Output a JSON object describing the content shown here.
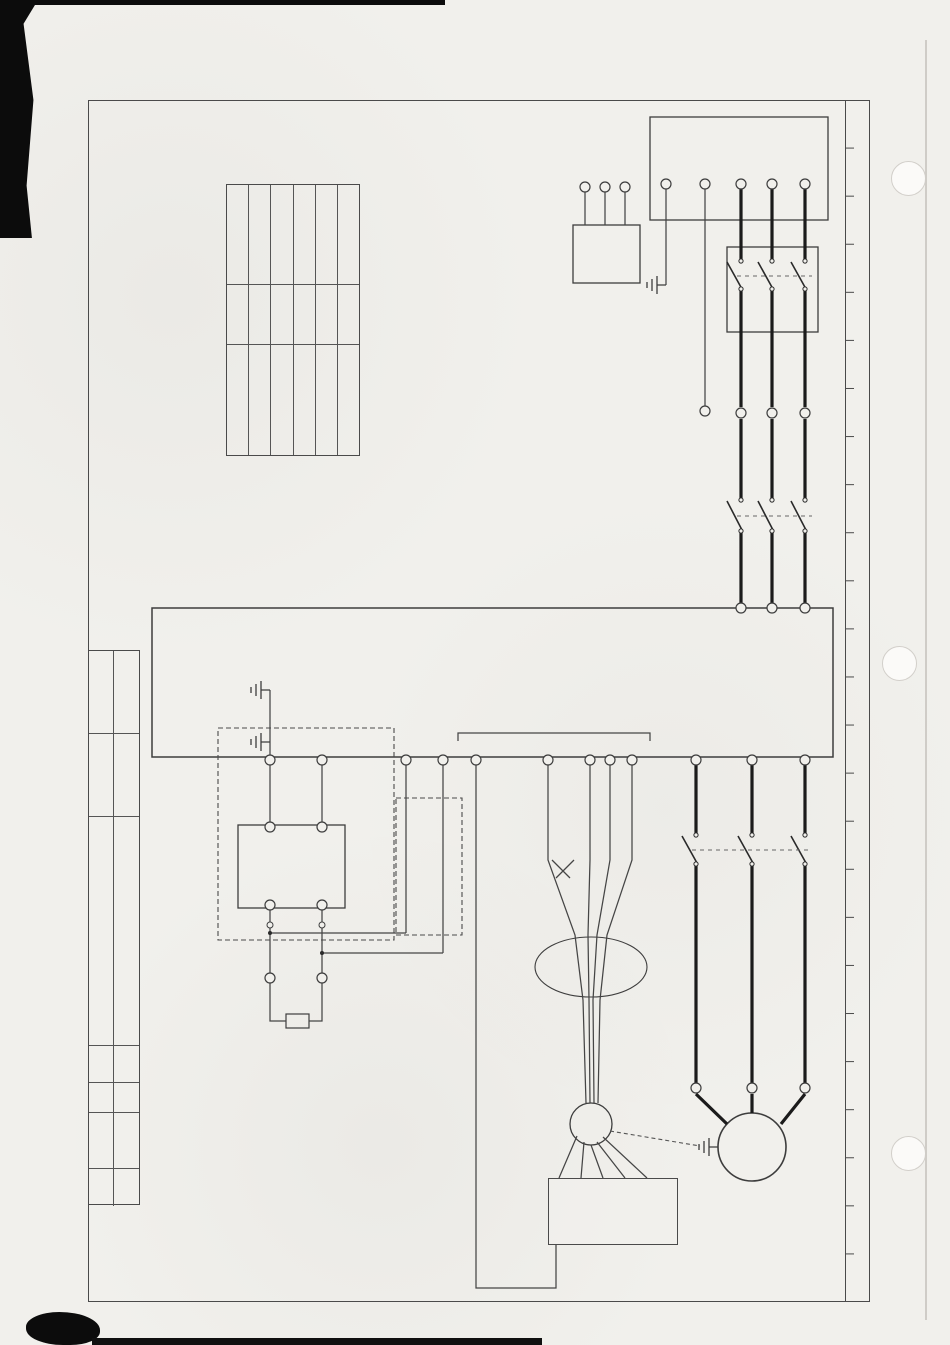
{
  "header": {
    "source_note": "本资料来自赛尔电梯网：http://dt.saier360.com/"
  },
  "frame": {
    "zone_letters": [
      "A",
      "B",
      "C",
      "D",
      "E",
      "F",
      "G",
      "H",
      "I",
      "J",
      "K",
      "L",
      "M",
      "N",
      "O",
      "P",
      "Q",
      "R",
      "S",
      "T",
      "U",
      "V",
      "W",
      "X",
      "Y"
    ]
  },
  "notes_right": [
    "1：用户需要根据土建要求，提供符合要求的三相五线电源。",
    "2：NICE3000一体化控制器，在30KW及以下功率机型都标准配置制动单元。37KW及其以上功率的机型需要外配制动单元。",
    "3：制动电阻参照以下电阻选型表配置"
  ],
  "notes_left": [
    "4：异步电机适配编码器为推挽输出，开路集电极输出的增量型编码器。",
    "5：编码器屏蔽线最好单端接地，当用户地线不稳定时，可以将屏蔽层接至控制板CN6的PGM端子。"
  ],
  "model_table": {
    "headers": [
      "型号",
      "功率等级",
      "制动电阻规格"
    ],
    "rows": [
      [
        "NICE-L-A-4P-4007",
        "7.5KW",
        "2500W, 65Ω"
      ],
      [
        "NICE-L-A-4P-4011",
        "11KW",
        "3500W, 43Ω"
      ],
      [
        "NICE-L-A-4P-4015",
        "15KW",
        "4500W, 32Ω"
      ],
      [
        "NICE-L-A-4P-4018",
        "18.5KW",
        "5500W, 25Ω"
      ],
      [
        "NICE-L-A-4P-4022",
        "22KW",
        "6500W, 22Ω"
      ],
      [
        "NICE-L-A-4P-4030",
        "30KW",
        "9500W, 16Ω"
      ]
    ]
  },
  "power_input": {
    "title": "用户三相五线进线",
    "terminals": [
      "L1",
      "L2",
      "L3",
      "N",
      "PE"
    ]
  },
  "breaker": {
    "label": "Q",
    "top_numbers": [
      "1",
      "3",
      "5"
    ],
    "bottom_numbers": [
      "2",
      "4",
      "6"
    ]
  },
  "kxx": {
    "label": "KXX",
    "terminals": [
      "W1",
      "V1",
      "U1"
    ],
    "wire_refs": [
      "(01B)",
      "(01B)",
      "(01B)"
    ]
  },
  "mid_terminals": {
    "labels": [
      "U1",
      "V1",
      "W1",
      "N"
    ],
    "refs": [
      "(01C)(03B)",
      "(01C)(03B)",
      "(01C)",
      "(02B)"
    ]
  },
  "ky": {
    "labels": [
      "KY",
      "KY",
      "KY"
    ],
    "top_numbers": [
      "2",
      "4",
      "6"
    ],
    "bottom_refs": [
      "1 (01G)",
      "3 (01G)",
      "5 (01G)"
    ]
  },
  "kk1": {
    "labels": [
      "KK1",
      "KK1",
      "KK1"
    ],
    "top_numbers": [
      "1",
      "3",
      "5"
    ],
    "bottom_refs": [
      "2 (04B)",
      "4 (04B)",
      "6 (04B)"
    ]
  },
  "inverter": {
    "name": "变频器",
    "model": "NICE3000(异步)",
    "input_terminals": [
      "R",
      "S",
      "T"
    ],
    "output_terminals": [
      "U",
      "V",
      "W"
    ],
    "dc_terminals": [
      "(-)",
      "(+)"
    ],
    "mcb_label": "MCTC-MCB-A",
    "mcb_terminals": [
      "PB",
      "(+)",
      "PE",
      "PGB",
      "PGA",
      "PGM",
      "15V"
    ],
    "wire_labels": [
      "B",
      "A",
      "0V",
      "+15V"
    ]
  },
  "brake_unit": {
    "box_label": "有制动单元时接",
    "size_note": "37KW以上使用制动单元",
    "name": "BRM",
    "plus_mark": "+",
    "minus_mark": "-",
    "wire_b": "B",
    "wire_p": "P"
  },
  "no_brake_unit": {
    "box_label": "无制动单元时接"
  },
  "brake_resistor": {
    "code": "RZD",
    "label": "制动电阻"
  },
  "motor": {
    "label": "M 1",
    "terminals": [
      "W2",
      "V2",
      "U2"
    ],
    "encoder_label": "PG"
  },
  "tb3": {
    "header_name": "编码器信号",
    "header_code": "TB3",
    "pins": [
      [
        "5",
        "PE"
      ],
      [
        "4",
        "0V"
      ],
      [
        "3",
        "+15V"
      ],
      [
        "2",
        "B"
      ],
      [
        "1",
        "A"
      ]
    ]
  },
  "title_block": {
    "date_label": "日期",
    "date": "08/11/01",
    "page_label": "页码",
    "page": "SHEET 01 OF 14",
    "title": "G20系列微机控制电梯——变频器控制回路",
    "company": "苏州巨立电梯有限公司",
    "design_label": "设计",
    "designer": "洪绸微",
    "check_label": "审核",
    "note_label": "注明",
    "note": "异步/一体机系统电梯 通用图",
    "version_label": "版本",
    "version": "8.01"
  }
}
